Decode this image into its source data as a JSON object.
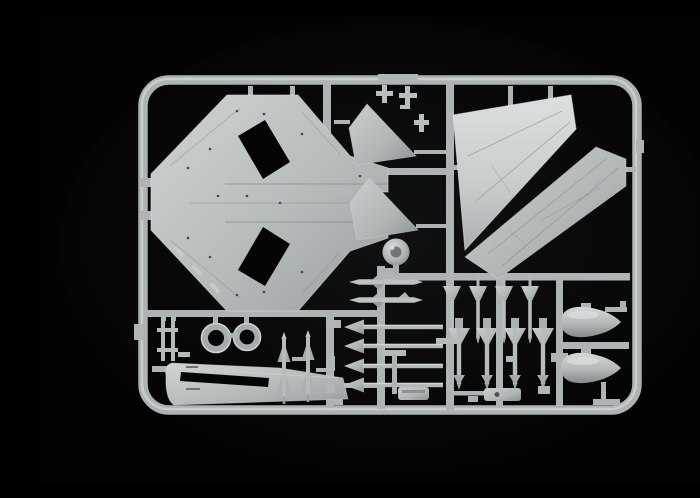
{
  "scene": {
    "subject": "product-photo-of-model-kit-sprue",
    "description": "Light grey injection-moulded plastic sprue with aircraft model parts on a black studio background",
    "material": "light grey polystyrene",
    "backdrop": "black"
  },
  "colors": {
    "background": "#030303",
    "glow": "#101112",
    "frame": "#adb2b4",
    "rail": "#aeb3b5",
    "plastic_base": "#b4b9ba",
    "plastic_highlight": "#d7dbdc",
    "plastic_shadow": "#8a8f91",
    "panel_line": "#7e8385",
    "hole": "#050505"
  },
  "sprue": {
    "frame_shape": "rounded-rectangle",
    "parts": [
      {
        "name": "delta-wing fuselage half",
        "count": 1
      },
      {
        "name": "vertical tail fin half",
        "count": 2
      },
      {
        "name": "large wing panel",
        "count": 2
      },
      {
        "name": "nose cone / spinner",
        "count": 1
      },
      {
        "name": "fuselage spine with cockpit opening",
        "count": 1
      },
      {
        "name": "wheel tire",
        "count": 2
      },
      {
        "name": "landing gear strut ladder",
        "count": 1
      },
      {
        "name": "dart rocket",
        "count": 4
      },
      {
        "name": "delta-finned missile",
        "count": 4
      },
      {
        "name": "sidewinder missile",
        "count": 2
      },
      {
        "name": "slim missile body",
        "count": 2
      },
      {
        "name": "arrow rocket",
        "count": 4
      },
      {
        "name": "drop tank half",
        "count": 2
      },
      {
        "name": "pylon launch rail",
        "count": 2
      },
      {
        "name": "equipment pod",
        "count": 2
      },
      {
        "name": "small brackets and fittings",
        "count": 8
      }
    ]
  }
}
